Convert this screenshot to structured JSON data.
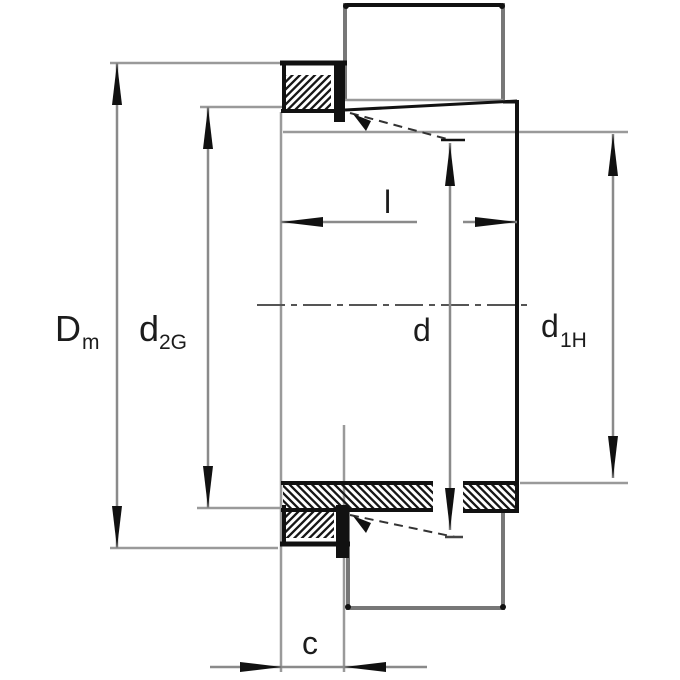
{
  "figure": {
    "kind": "bearing-adapter-sleeve-section-drawing",
    "dimension_labels": {
      "dm": {
        "main": "D",
        "sub": "m"
      },
      "d2g": {
        "main": "d",
        "sub": "2G"
      },
      "l": {
        "main": "l"
      },
      "d": {
        "main": "d"
      },
      "d1h": {
        "main": "d",
        "sub": "1H"
      },
      "c": {
        "main": "c"
      }
    },
    "colors": {
      "background": "#ffffff",
      "outline_black": "#111111",
      "outline_gray": "#777777",
      "dimension_gray": "#8a8a8a",
      "extension_gray": "#9a9a9a",
      "text": "#1c1c1c"
    }
  }
}
